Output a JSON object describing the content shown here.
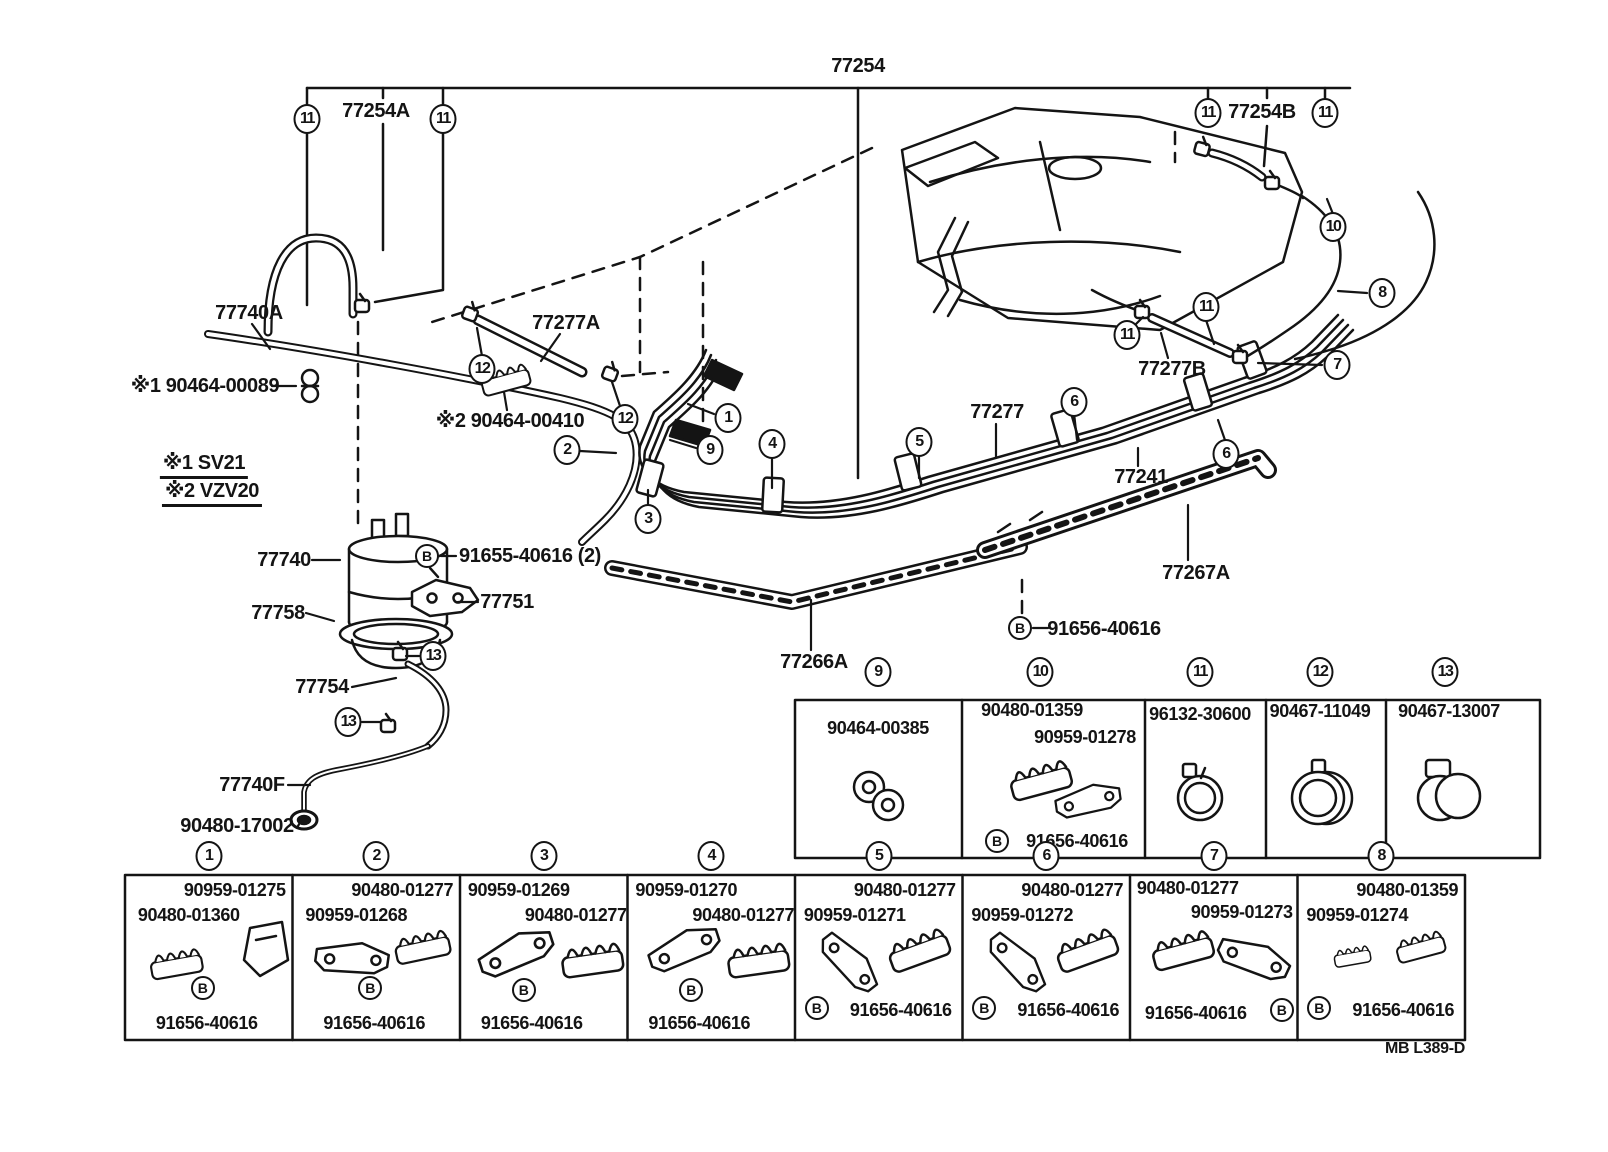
{
  "page": {
    "background": "#ffffff",
    "ink": "#141414",
    "footer_code": "MB L389-D"
  },
  "diagram": {
    "b_letter": "B",
    "labels": [
      {
        "text": "77254",
        "x": 858,
        "y": 66
      },
      {
        "text": "77254A",
        "x": 376,
        "y": 111
      },
      {
        "text": "77254B",
        "x": 1262,
        "y": 112
      },
      {
        "text": "77740A",
        "x": 249,
        "y": 313
      },
      {
        "text": "※1 90464-00089",
        "x": 205,
        "y": 386
      },
      {
        "text": "77277A",
        "x": 566,
        "y": 323
      },
      {
        "text": "※2 90464-00410",
        "x": 510,
        "y": 421
      },
      {
        "text": "※1 SV21",
        "x": 204,
        "y": 466,
        "underline": true
      },
      {
        "text": "※2 VZV20",
        "x": 212,
        "y": 494,
        "underline": true
      },
      {
        "text": "77740",
        "x": 284,
        "y": 560
      },
      {
        "text": "91655-40616 (2)",
        "x": 530,
        "y": 556
      },
      {
        "text": "77758",
        "x": 278,
        "y": 613
      },
      {
        "text": "77751",
        "x": 507,
        "y": 602
      },
      {
        "text": "77754",
        "x": 322,
        "y": 687
      },
      {
        "text": "77740F",
        "x": 252,
        "y": 785
      },
      {
        "text": "90480-17002",
        "x": 237,
        "y": 826
      },
      {
        "text": "77277",
        "x": 997,
        "y": 412
      },
      {
        "text": "77241",
        "x": 1141,
        "y": 477
      },
      {
        "text": "77267A",
        "x": 1196,
        "y": 573
      },
      {
        "text": "91656-40616",
        "x": 1104,
        "y": 629
      },
      {
        "text": "77266A",
        "x": 814,
        "y": 662
      },
      {
        "text": "77277B",
        "x": 1172,
        "y": 369
      }
    ],
    "callouts": [
      {
        "n": "11",
        "x": 307,
        "y": 119
      },
      {
        "n": "11",
        "x": 443,
        "y": 119
      },
      {
        "n": "12",
        "x": 482,
        "y": 369
      },
      {
        "n": "12",
        "x": 625,
        "y": 419
      },
      {
        "n": "1",
        "x": 728,
        "y": 418
      },
      {
        "n": "9",
        "x": 710,
        "y": 450
      },
      {
        "n": "2",
        "x": 567,
        "y": 450
      },
      {
        "n": "3",
        "x": 648,
        "y": 519
      },
      {
        "n": "4",
        "x": 772,
        "y": 444
      },
      {
        "n": "5",
        "x": 919,
        "y": 442
      },
      {
        "n": "6",
        "x": 1074,
        "y": 402
      },
      {
        "n": "6",
        "x": 1226,
        "y": 454
      },
      {
        "n": "7",
        "x": 1337,
        "y": 365
      },
      {
        "n": "8",
        "x": 1382,
        "y": 293
      },
      {
        "n": "11",
        "x": 1127,
        "y": 335
      },
      {
        "n": "11",
        "x": 1206,
        "y": 307
      },
      {
        "n": "10",
        "x": 1333,
        "y": 227
      },
      {
        "n": "11",
        "x": 1208,
        "y": 113
      },
      {
        "n": "11",
        "x": 1325,
        "y": 113
      },
      {
        "n": "13",
        "x": 433,
        "y": 656
      },
      {
        "n": "13",
        "x": 348,
        "y": 722
      }
    ],
    "b_markers": [
      {
        "x": 427,
        "y": 556
      },
      {
        "x": 1020,
        "y": 628
      }
    ]
  },
  "mid_table": {
    "cells": [
      {
        "callout": "9",
        "parts": [
          "90464-00385"
        ],
        "bottom": null
      },
      {
        "callout": "10",
        "parts": [
          "90480-01359",
          "90959-01278"
        ],
        "bottom": "91656-40616"
      },
      {
        "callout": "11",
        "parts": [
          "96132-30600"
        ],
        "bottom": null
      },
      {
        "callout": "12",
        "parts": [
          "90467-11049"
        ],
        "bottom": null
      },
      {
        "callout": "13",
        "parts": [
          "90467-13007"
        ],
        "bottom": null
      }
    ]
  },
  "bottom_table": {
    "cells": [
      {
        "callout": "1",
        "top": "90959-01275",
        "side": "90480-01360",
        "bottom": "91656-40616",
        "variant": "A"
      },
      {
        "callout": "2",
        "top": "90480-01277",
        "side": "90959-01268",
        "bottom": "91656-40616",
        "variant": "A"
      },
      {
        "callout": "3",
        "top": "90959-01269",
        "side": "90480-01277",
        "bottom": "91656-40616",
        "variant": "B"
      },
      {
        "callout": "4",
        "top": "90959-01270",
        "side": "90480-01277",
        "bottom": "91656-40616",
        "variant": "B"
      },
      {
        "callout": "5",
        "top": "90480-01277",
        "side": "90959-01271",
        "bottom": "91656-40616",
        "variant": "C"
      },
      {
        "callout": "6",
        "top": "90480-01277",
        "side": "90959-01272",
        "bottom": "91656-40616",
        "variant": "C"
      },
      {
        "callout": "7",
        "top": "90480-01277",
        "side": "90959-01273",
        "bottom": "91656-40616",
        "variant": "D"
      },
      {
        "callout": "8",
        "top": "90480-01359",
        "side": "90959-01274",
        "bottom": "91656-40616",
        "variant": "C"
      }
    ]
  }
}
